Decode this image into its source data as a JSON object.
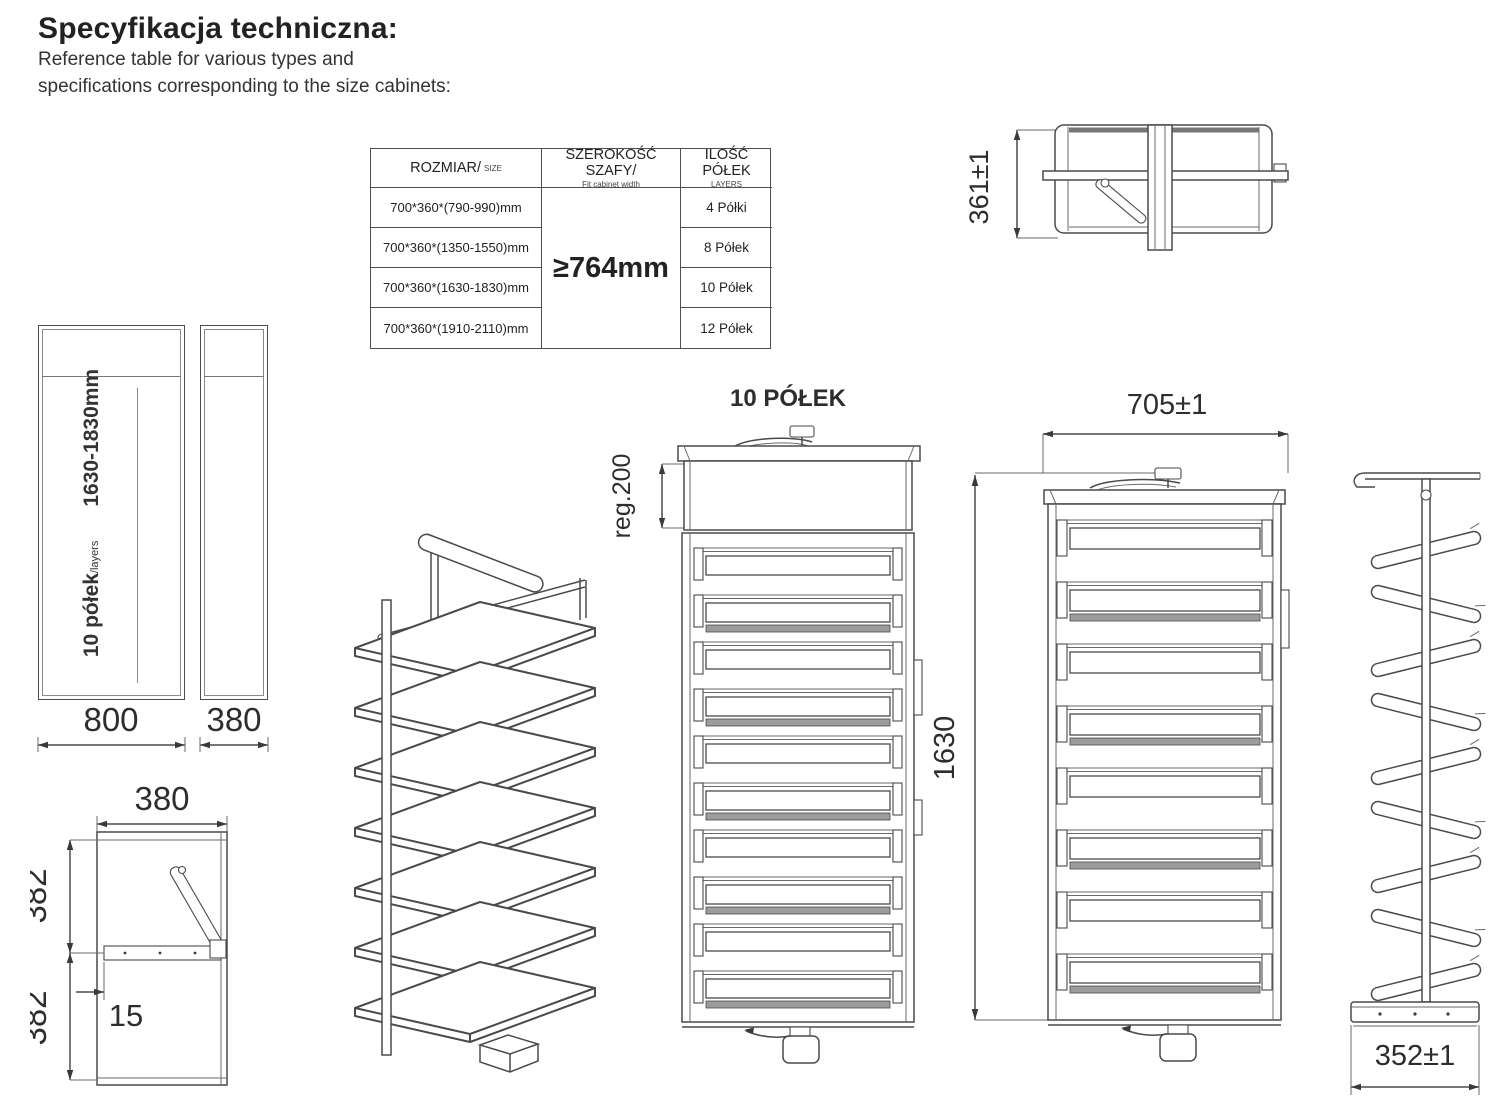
{
  "page": {
    "title": "Specyfikacja techniczna:",
    "subtitle1": "Reference table for various types and",
    "subtitle2": "specifications corresponding to the size cabinets:"
  },
  "style": {
    "ink_color": "#4a4a4a",
    "paper_color": "#ffffff"
  },
  "spec_table": {
    "col_size_label": "ROZMIAR/",
    "col_size_sublabel": "SIZE",
    "col_width_label": "SZEROKOŚĆ SZAFY/",
    "col_width_sublabel": "Fit cabinet width",
    "col_shelves_label": "ILOŚĆ PÓŁEK",
    "col_shelves_sublabel": "LAYERS",
    "cabinet_width_value": "≥764mm",
    "rows": [
      {
        "size": "700*360*(790-990)mm",
        "shelves": "4 Półki"
      },
      {
        "size": "700*360*(1350-1550)mm",
        "shelves": "8 Półek"
      },
      {
        "size": "700*360*(1630-1830)mm",
        "shelves": "10 Półek"
      },
      {
        "size": "700*360*(1910-2110)mm",
        "shelves": "12 Półek"
      }
    ]
  },
  "cabinet_label": {
    "shelves": "10 półek",
    "shelves_small": "/layers",
    "range": "1630-1830mm"
  },
  "dimensions": {
    "top_view_height": "361±1",
    "cabinet_front_width": "800",
    "cabinet_side_width": "380",
    "mount_width": "380",
    "mount_upper": "382",
    "mount_lower": "382",
    "mount_offset": "15",
    "front_view_title": "10 PÓŁEK",
    "front_top_adjust": "reg.200",
    "unit_width": "705±1",
    "unit_height": "1630",
    "unit_depth": "352±1"
  }
}
